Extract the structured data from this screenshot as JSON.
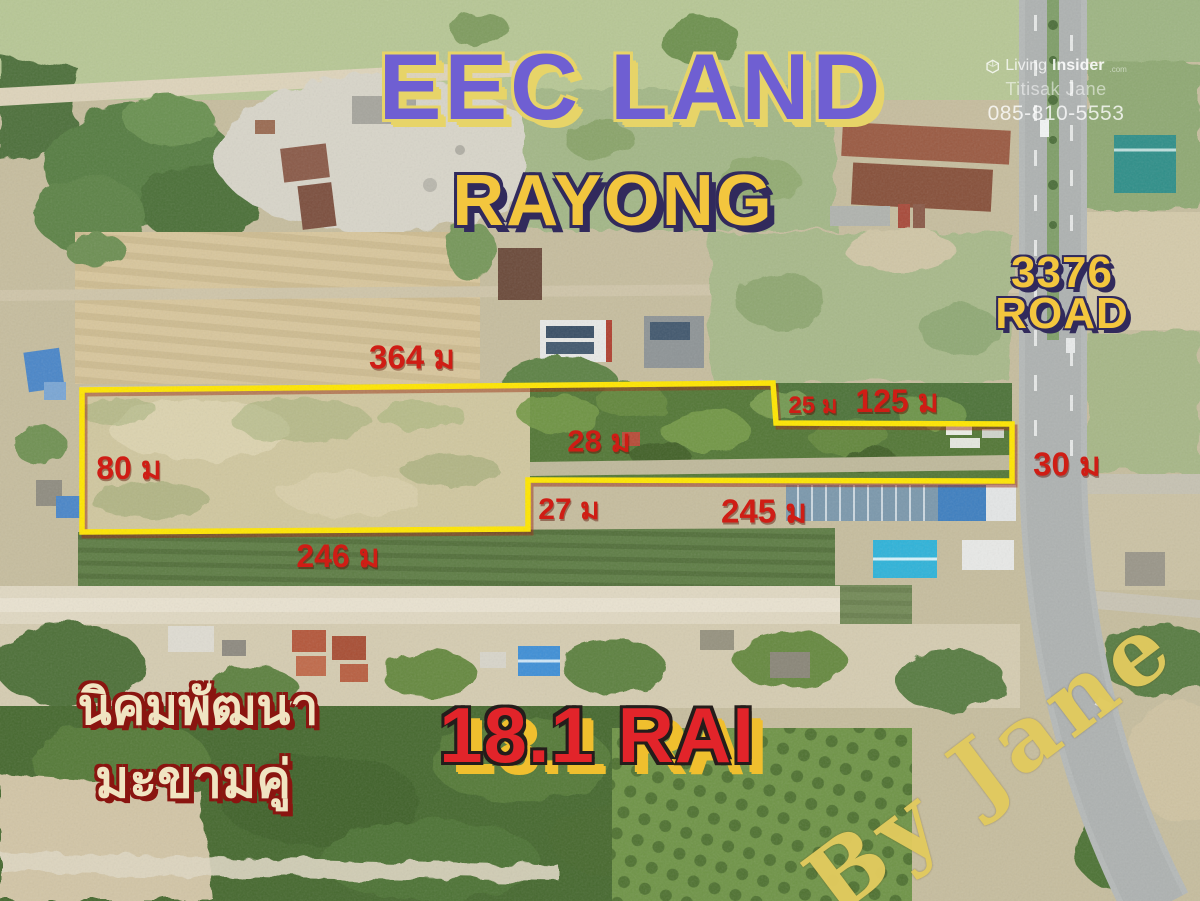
{
  "header": {
    "title": "EEC LAND",
    "subtitle": "RAYONG"
  },
  "watermark": {
    "brand_prefix": "Living",
    "brand_bold": "Insider",
    "brand_tld": ".com",
    "agent_name": "Titisak Jane",
    "phone": "085-810-5553"
  },
  "road_sign": {
    "number": "3376",
    "word": "ROAD"
  },
  "plot": {
    "area_label": "18.1 RAI",
    "boundary_points": [
      [
        82,
        390
      ],
      [
        773,
        383
      ],
      [
        776,
        423
      ],
      [
        1012,
        424
      ],
      [
        1012,
        481
      ],
      [
        528,
        480
      ],
      [
        528,
        529
      ],
      [
        82,
        532
      ]
    ],
    "measurements": {
      "top_edge": "364 ม",
      "step_edge": "25 ม",
      "upper_right_edge": "125 ม",
      "inner_width": "28 ม",
      "right_edge": "30 ม",
      "left_edge": "80 ม",
      "lower_step_edge": "27 ม",
      "bottom_right_edge": "245 ม",
      "bottom_left_edge": "246 ม"
    }
  },
  "district": {
    "line1": "นิคมพัฒนา",
    "line2": "มะขามคู่"
  },
  "signature": "By Jane",
  "colors": {
    "accent_purple": "#6f5fd2",
    "title_outline_yellow": "#e7d468",
    "accent_yellow": "#f3c63e",
    "subtitle_outline_navy": "#312a5c",
    "measure_red": "#cf1d15",
    "area_red": "#e2242a",
    "area_outline_dark": "#241d1b",
    "area_glow_yellow": "#f0bf2e",
    "thai_cream": "#f0e4c2",
    "thai_outline_red": "#8a1510",
    "boundary_yellow": "#ffe600",
    "signature_yellow": "#e1ca5e"
  }
}
